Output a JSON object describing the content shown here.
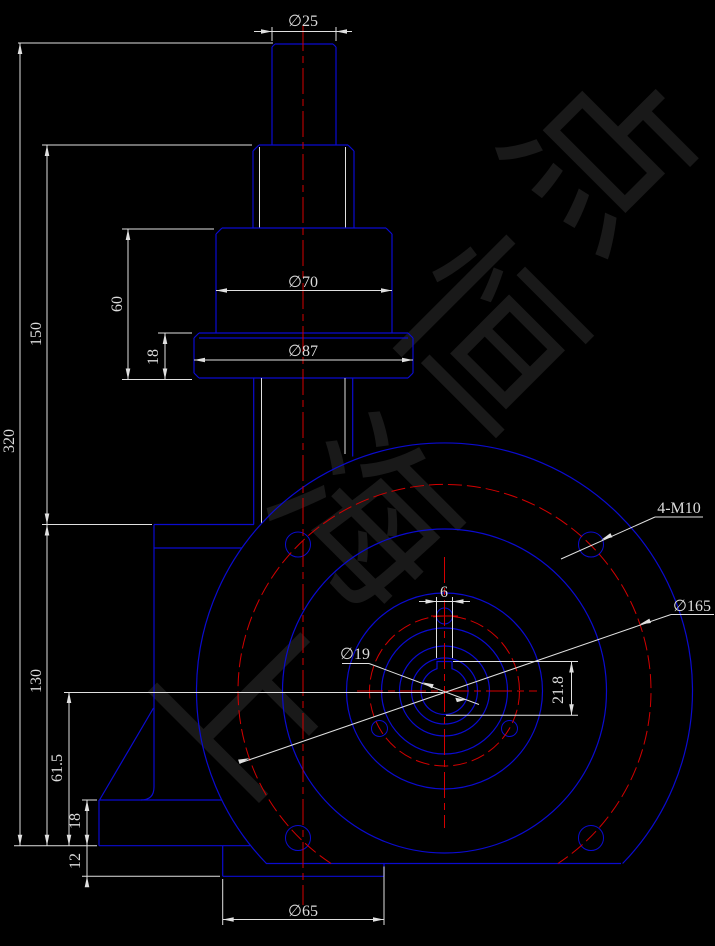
{
  "meta": {
    "type": "CAD engineering drawing",
    "subject": "worm gearbox elevation"
  },
  "colors": {
    "background": "#000000",
    "geometry_blue": "#0b0bd0",
    "centerline_red": "#d40000",
    "dimension_white": "#dcdcdc",
    "watermark_gray": "#191919"
  },
  "watermark": {
    "text": "上海恒点",
    "chars": [
      "上",
      "海",
      "恒",
      "点"
    ]
  },
  "dimensions": {
    "shaft_dia": "∅25",
    "hub_dia": "∅70",
    "flange_dia": "∅87",
    "boss_dia": "∅65",
    "overall_height": "320",
    "upper_height": "150",
    "lower_height": "130",
    "hub_height": "60",
    "flange_thickness": "18",
    "foot_to_center": "61.5",
    "foot_height": "18",
    "boss_protrusion": "12",
    "keyway_width": "6",
    "keyway_depth": "21.8",
    "bore_dia": "∅19",
    "bolt_circle_dia": "∅165",
    "thread_callout": "4-M10"
  }
}
